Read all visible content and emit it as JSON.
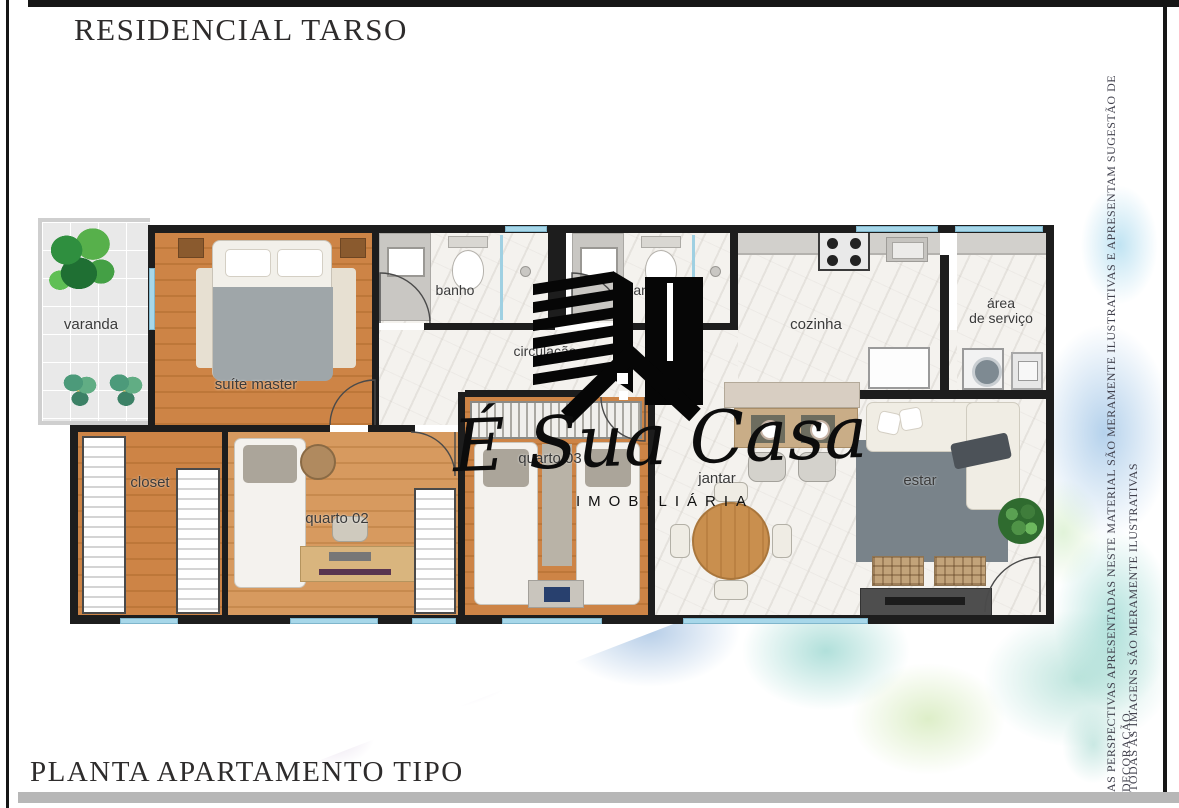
{
  "header": {
    "title": "RESIDENCIAL TARSO"
  },
  "footer": {
    "title": "PLANTA APARTAMENTO TIPO"
  },
  "disclaimers": {
    "line1": "AS PERSPECTIVAS APRESENTADAS NESTE MATERIAL SÃO MERAMENTE ILUSTRATIVAS E APRESENTAM SUGESTÃO DE DECORAÇÃO.",
    "line2": "TODAS AS IMAGENS SÃO MERAMENTE ILUSTRATIVAS"
  },
  "brand": {
    "script": "É Sua Casa",
    "subtitle": "IMOBILIÁRIA"
  },
  "floorplan": {
    "rooms": [
      {
        "id": "varanda",
        "label": "varanda"
      },
      {
        "id": "suite-master",
        "label": "suíte master"
      },
      {
        "id": "banho-1",
        "label": "banho"
      },
      {
        "id": "banho-2",
        "label": "banho"
      },
      {
        "id": "circulacao",
        "label": "circulação"
      },
      {
        "id": "cozinha",
        "label": "cozinha"
      },
      {
        "id": "area-de-servico",
        "label": "área de serviço",
        "line1": "área",
        "line2": "de serviço"
      },
      {
        "id": "closet",
        "label": "closet"
      },
      {
        "id": "quarto-02",
        "label": "quarto 02"
      },
      {
        "id": "quarto-03",
        "label": "quarto 03"
      },
      {
        "id": "jantar",
        "label": "jantar"
      },
      {
        "id": "estar",
        "label": "estar"
      }
    ]
  },
  "colors": {
    "wall": "#1d1d1d",
    "window": "#a7d7e9",
    "wood_floor": "#cd8446",
    "marble_floor": "#f4f2ee",
    "frame_gray": "#b7b7b7",
    "watercolor_blue": "#6faad7",
    "watercolor_teal": "#6fc4b4",
    "watercolor_purple": "#a583b9",
    "watercolor_green": "#b4d77d"
  }
}
